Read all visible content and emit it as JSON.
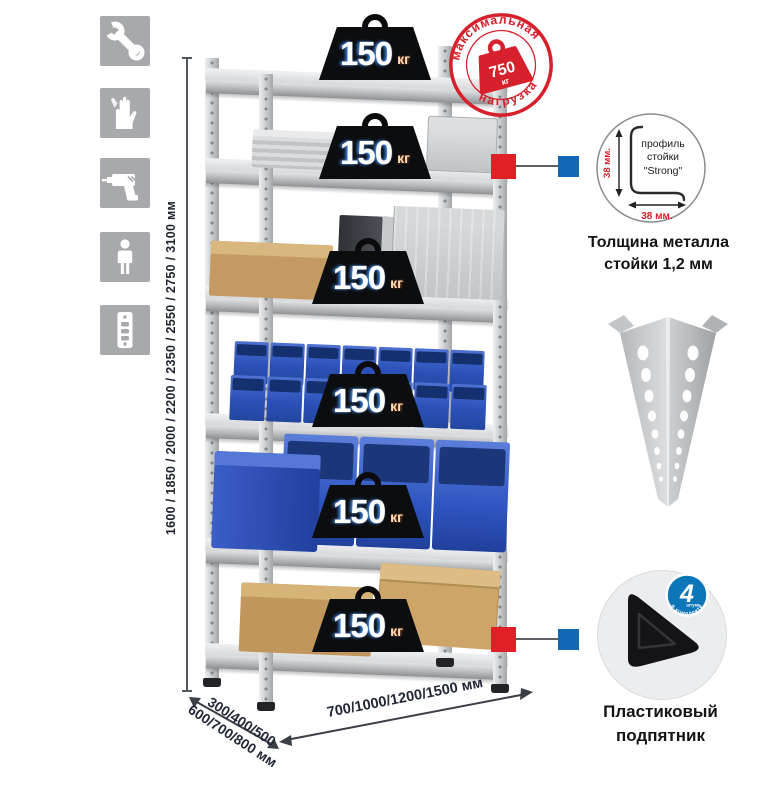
{
  "sidebar": {
    "icons": [
      "wrench",
      "gloves",
      "drill",
      "person",
      "rack-post"
    ]
  },
  "load_badge": {
    "value": "150",
    "unit": "кг"
  },
  "stamp": {
    "arc_top": "максимальная",
    "arc_bottom": "нагрузка",
    "value": "750",
    "unit": "кг"
  },
  "profile_callout": {
    "line1": "профиль",
    "line2": "стойки",
    "line3": "\"Strong\"",
    "dim_vertical": "38 мм.",
    "dim_horizontal": "38 мм.",
    "caption_line1": "Толщина металла",
    "caption_line2": "стойки 1,2 мм"
  },
  "foot_callout": {
    "badge_number": "4",
    "badge_unit": "штуки",
    "badge_arc": "в комплекте",
    "caption_line1": "Пластиковый",
    "caption_line2": "подпятник"
  },
  "dimensions": {
    "height": "1600 / 1850 / 2000 / 2200 / 2350 / 2550 / 2750 / 3100 мм",
    "depth_line1": "300/400/500",
    "depth_line2": "600/700/800 мм",
    "width": "700/1000/1200/1500 мм"
  },
  "colors": {
    "stamp_red": "#d6202b",
    "connector_red": "#e01f26",
    "connector_blue": "#1268b3",
    "qty_badge_blue": "#0d76b8",
    "bin_blue": "#2e55c0",
    "metal_gray": "#c9cbcd",
    "icon_gray": "#a7a9ac"
  }
}
